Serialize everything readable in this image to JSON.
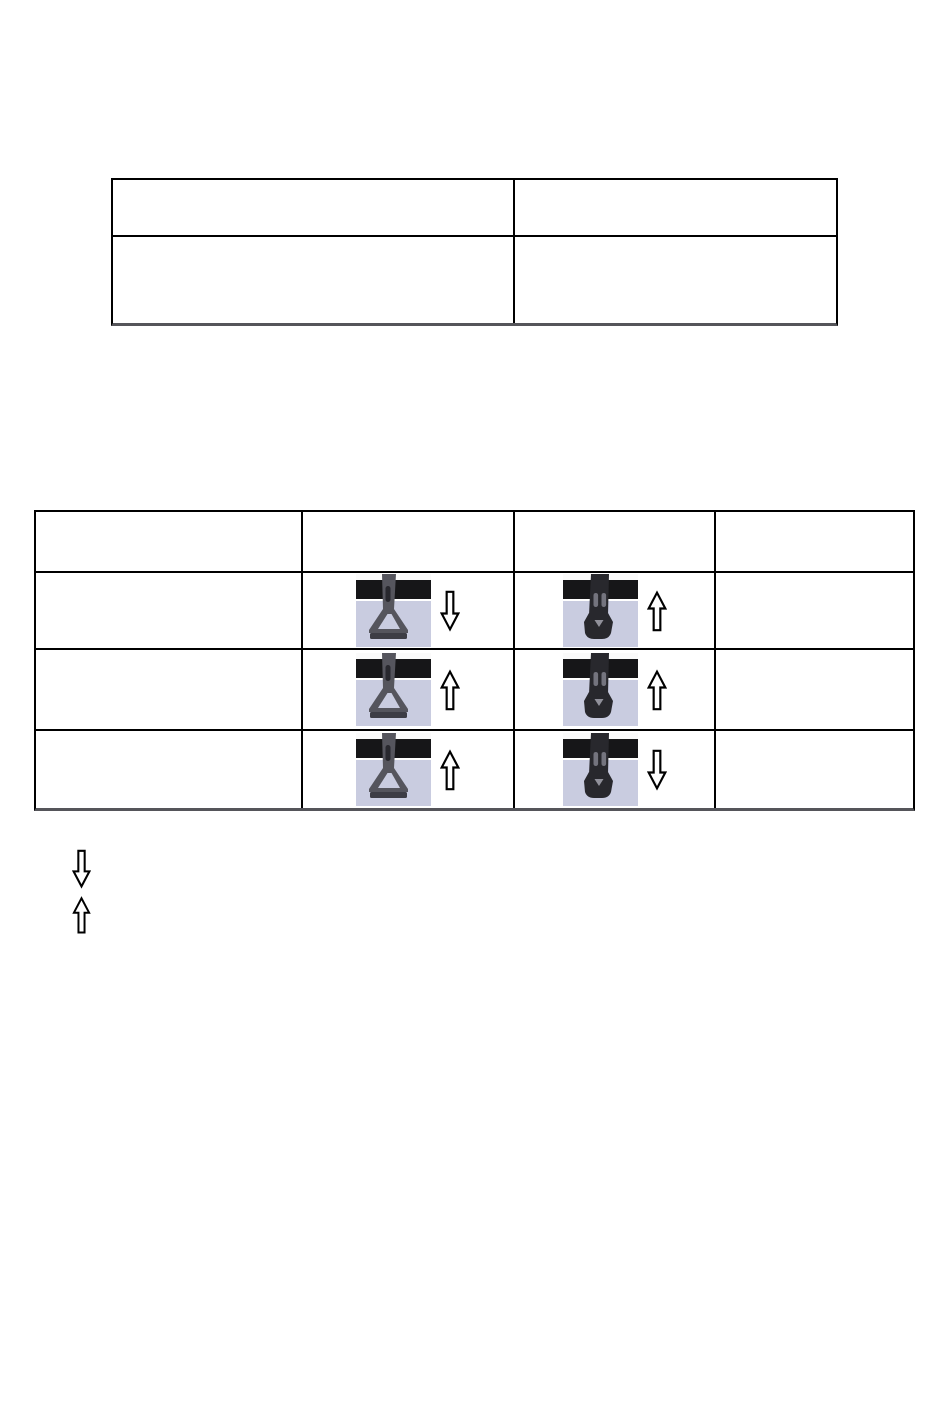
{
  "page": {
    "type": "manual-document-page",
    "background": "#ffffff"
  },
  "colors": {
    "table_border": "#000000",
    "table_bottom_edge": "#55555a",
    "photo_top_band": "#fafafa",
    "photo_bar": "#161618",
    "photo_backdrop": "#c9cce0",
    "strap_gray": "#55555d",
    "strap_gray_slot": "#28282e",
    "strap_gray_foot": "#3d3d45",
    "strap_dark": "#28282d",
    "strap_dark_slot": "#74747e",
    "strap_dark_notch": "#90909a",
    "arrow_fill": "#ffffff",
    "arrow_stroke": "#000000"
  },
  "top_table": {
    "rows": [
      {
        "cells": [
          "",
          ""
        ]
      },
      {
        "cells": [
          "",
          ""
        ]
      }
    ]
  },
  "adjustment_table": {
    "header": [
      "",
      "",
      "",
      ""
    ],
    "rows": [
      {
        "cells": [
          {
            "type": "empty",
            "text": ""
          },
          {
            "type": "photo",
            "strap": "gray-triangle-buckle",
            "arrow": "down"
          },
          {
            "type": "photo",
            "strap": "dark-twin-slot-buckle",
            "arrow": "up"
          },
          {
            "type": "empty",
            "text": ""
          }
        ]
      },
      {
        "cells": [
          {
            "type": "empty",
            "text": ""
          },
          {
            "type": "photo",
            "strap": "gray-triangle-buckle",
            "arrow": "up"
          },
          {
            "type": "photo",
            "strap": "dark-twin-slot-buckle",
            "arrow": "up"
          },
          {
            "type": "empty",
            "text": ""
          }
        ]
      },
      {
        "cells": [
          {
            "type": "empty",
            "text": ""
          },
          {
            "type": "photo",
            "strap": "gray-triangle-buckle",
            "arrow": "up"
          },
          {
            "type": "photo",
            "strap": "dark-twin-slot-buckle",
            "arrow": "down"
          },
          {
            "type": "empty",
            "text": ""
          }
        ]
      }
    ]
  },
  "legend": {
    "items": [
      {
        "icon": "down-arrow",
        "label": ""
      },
      {
        "icon": "up-arrow",
        "label": ""
      }
    ]
  }
}
